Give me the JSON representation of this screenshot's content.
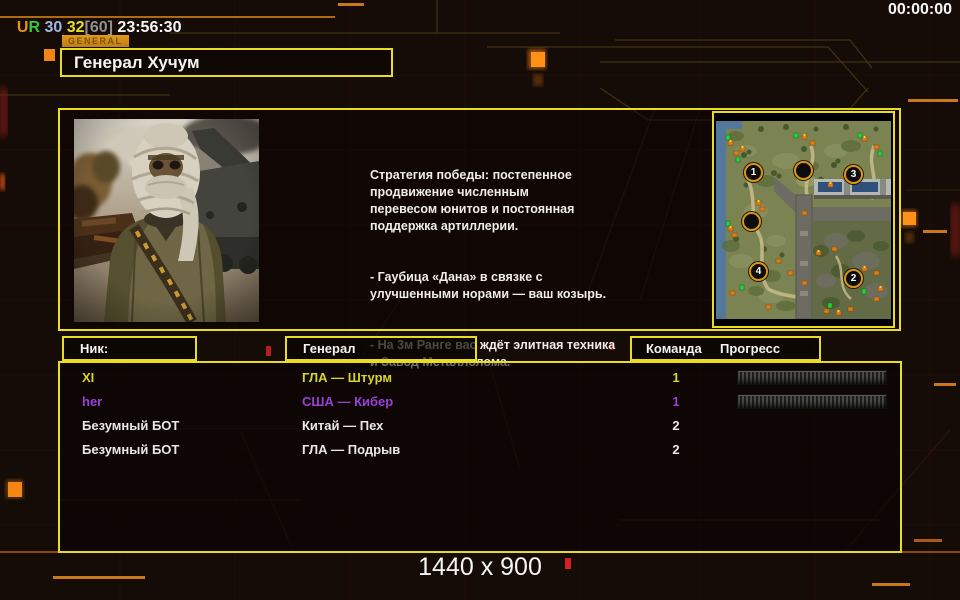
{
  "top_bar": {
    "segments": [
      {
        "text": "U",
        "color": "#e89018"
      },
      {
        "text": "R",
        "color": "#38c838"
      },
      {
        "text": " 30",
        "color": "#a0b8e8"
      },
      {
        "text": " 32",
        "color": "#e8e020"
      },
      {
        "text": "[60]",
        "color": "#909090"
      },
      {
        "text": " 23:56:30",
        "color": "#f8f8f8"
      }
    ],
    "clock_right": "00:00:00"
  },
  "general_tab": {
    "label": "GENERAL"
  },
  "title_box": {
    "title": "Генерал Хучум"
  },
  "info_panel": {
    "strategy_paragraphs": [
      "Стратегия победы: постепенное\nпродвижение численным\nперевесом юнитов и постоянная\nподдержка артиллерии.",
      "- Гаубица «Дана» в связке с\nулучшенными норами — ваш козырь.",
      "- На 3м Ранге вас ждёт элитная техника\nи Завод Металлолома."
    ]
  },
  "minimap": {
    "spots": [
      {
        "label": "1"
      },
      {
        "label": ""
      },
      {
        "label": "3"
      },
      {
        "label": ""
      },
      {
        "label": "4"
      },
      {
        "label": "2"
      }
    ]
  },
  "table": {
    "headers": {
      "nick": "Ник:",
      "general": "Генерал",
      "team": "Команда",
      "progress": "Прогресс"
    },
    "rows": [
      {
        "nick": "XI",
        "general": "ГЛА — Штурм",
        "team": "1",
        "color": "#d6d62a",
        "progress": true
      },
      {
        "nick": "her",
        "general": "США — Кибер",
        "team": "1",
        "color": "#9a3fd9",
        "progress": true
      },
      {
        "nick": "Безумный БОТ",
        "general": "Китай — Пех",
        "team": "2",
        "color": "#e8e8e6",
        "progress": false
      },
      {
        "nick": "Безумный БОТ",
        "general": "ГЛА — Подрыв",
        "team": "2",
        "color": "#e8e8e6",
        "progress": false
      }
    ]
  },
  "footer": {
    "resolution": "1440 x 900"
  },
  "colors": {
    "accent_yellow": "#eadc1e",
    "accent_orange": "#ff8a12",
    "team1_yellow": "#d6d62a",
    "team1_purple": "#9a3fd9"
  }
}
